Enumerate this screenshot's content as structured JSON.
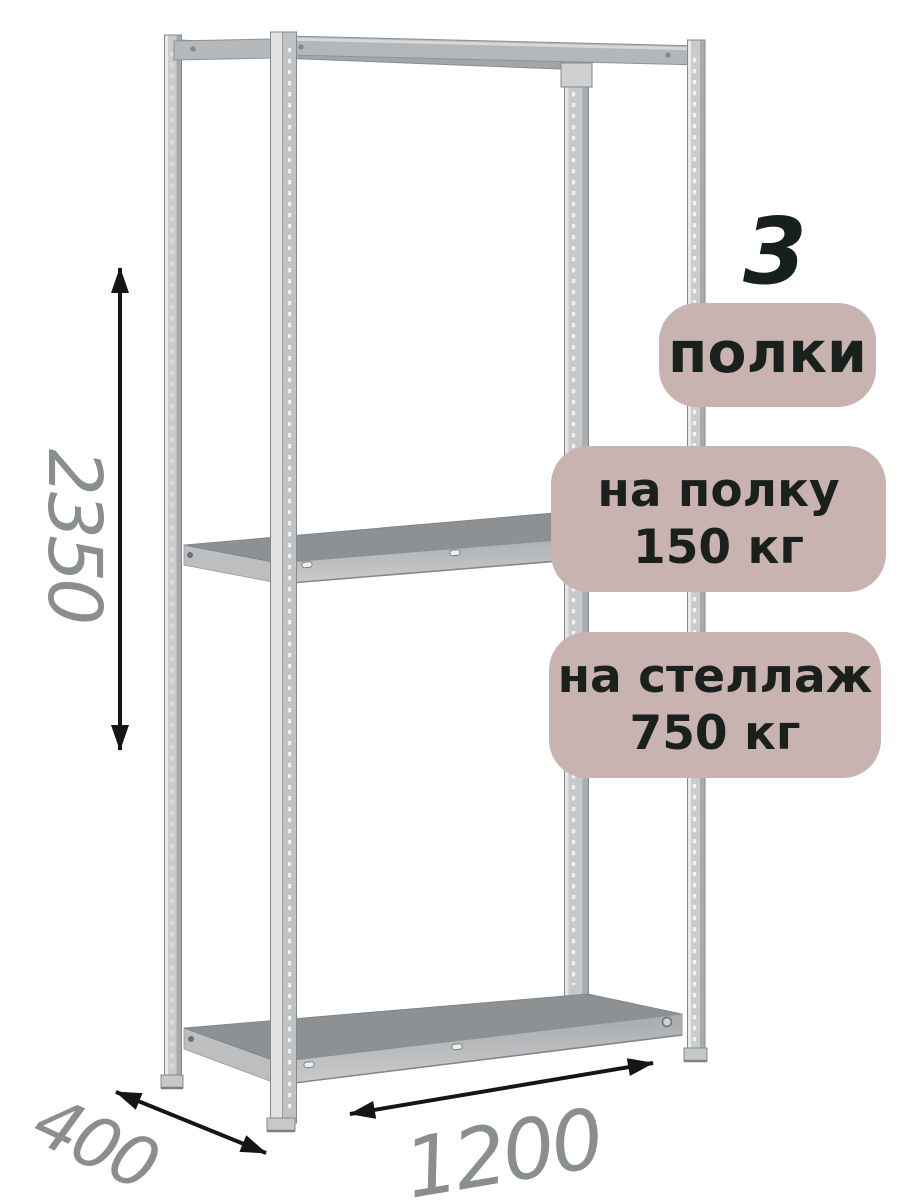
{
  "labels": {
    "shelf_count": "3",
    "shelf_count_unit": "полки",
    "per_shelf_line1": "на полку",
    "per_shelf_line2": "150 кг",
    "per_rack_line1": "на стеллаж",
    "per_rack_line2": "750 кг"
  },
  "dimensions": {
    "height_mm": "2350",
    "depth_mm": "400",
    "width_mm": "1200"
  },
  "colors": {
    "badge_background": "#c9b3b1",
    "badge_text": "#1a211d",
    "count_text": "#16211b",
    "dimension_text": "#8b8e8f",
    "arrow": "#151515",
    "background": "#ffffff"
  }
}
